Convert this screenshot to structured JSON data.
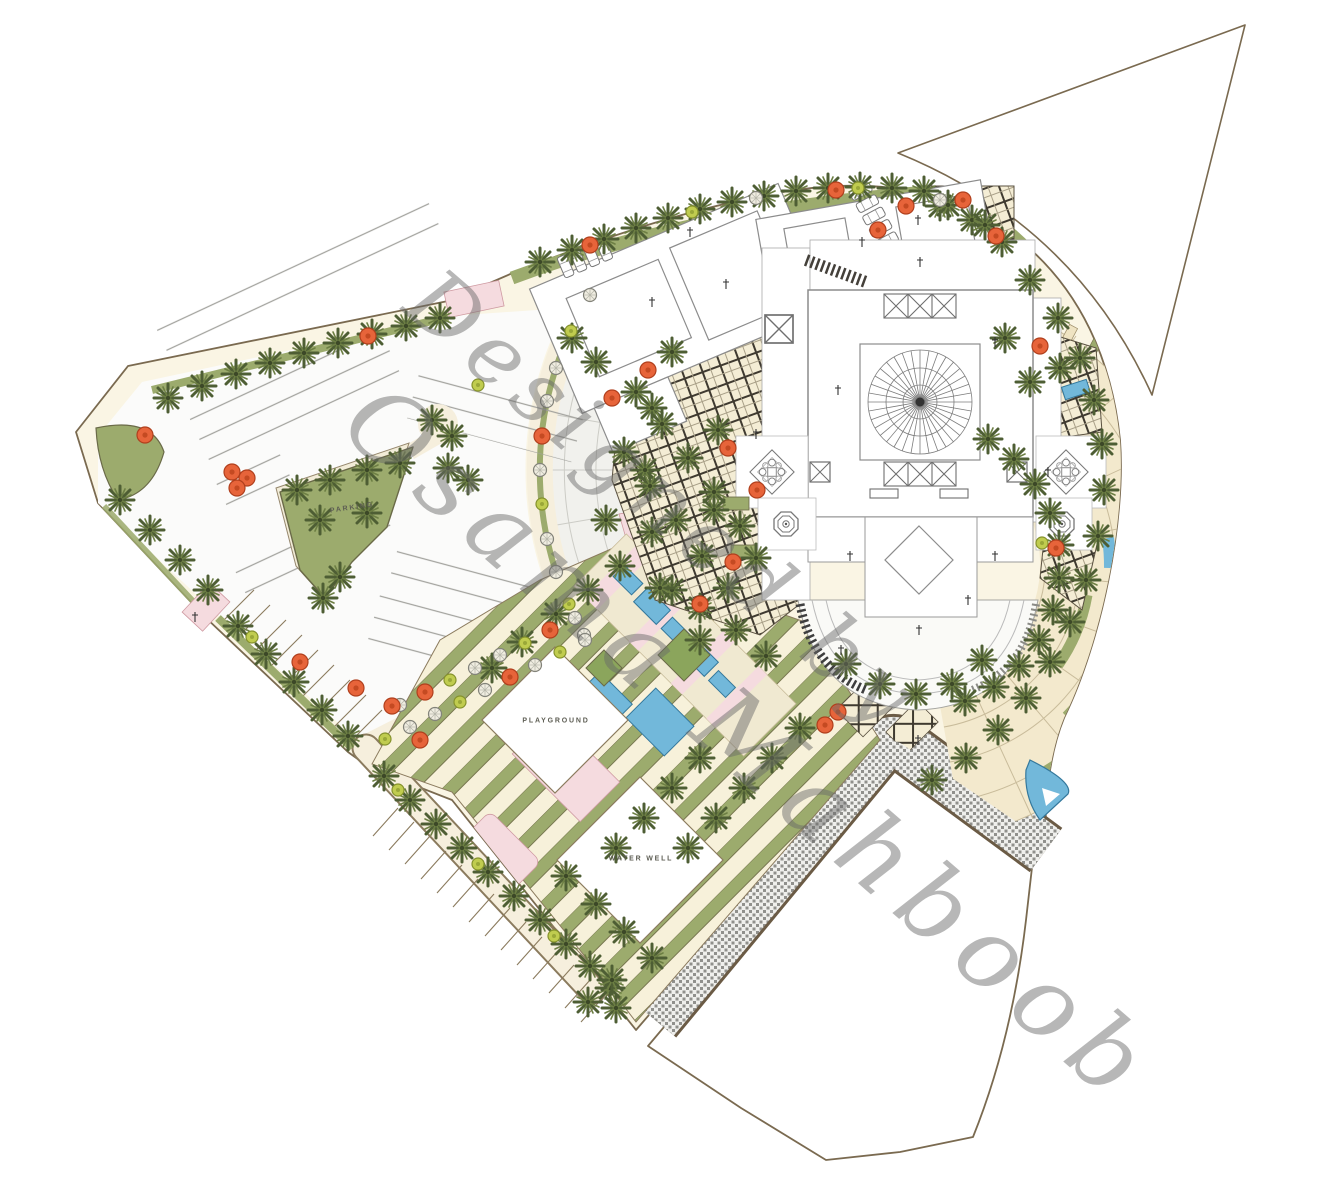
{
  "plan": {
    "type": "architectural-landscape-site-plan",
    "subject": "Mosque complex landscape master plan",
    "labels": {
      "parking": "PARKING",
      "playground": "PLAYGROUND",
      "water_well": "WATER WELL"
    },
    "watermark": {
      "line1": "Designed by",
      "line2": "Osama Mahboob"
    },
    "palette": {
      "paper": "#ffffff",
      "ground_cream": "#faf5e4",
      "site_outline": "#7a6a50",
      "asphalt": "#fbfbfa",
      "greenery": "#9cab6d",
      "palm_frond": "#4e5e34",
      "flowering_tree": "#e7643a",
      "water_blue": "#72b8da",
      "plaza_pink": "#f5dbdf",
      "trellis_line": "#3f3a30",
      "road_gray": "#90908c",
      "building_fill": "#ffffff",
      "building_line": "#8c8c8c",
      "watermark_gray": "#696969"
    },
    "features": [
      "parking-lot",
      "palm-trees",
      "flowering-trees",
      "radial-promenade",
      "trellis-plaza",
      "mosque-with-dome",
      "skylights",
      "minarets",
      "courtyard-diamond",
      "fountains",
      "garden-stripes",
      "playground",
      "water-well",
      "reflecting-pools",
      "terraced-gardens",
      "perimeter-road",
      "adjacent-parcel",
      "triangular-parcel"
    ]
  }
}
